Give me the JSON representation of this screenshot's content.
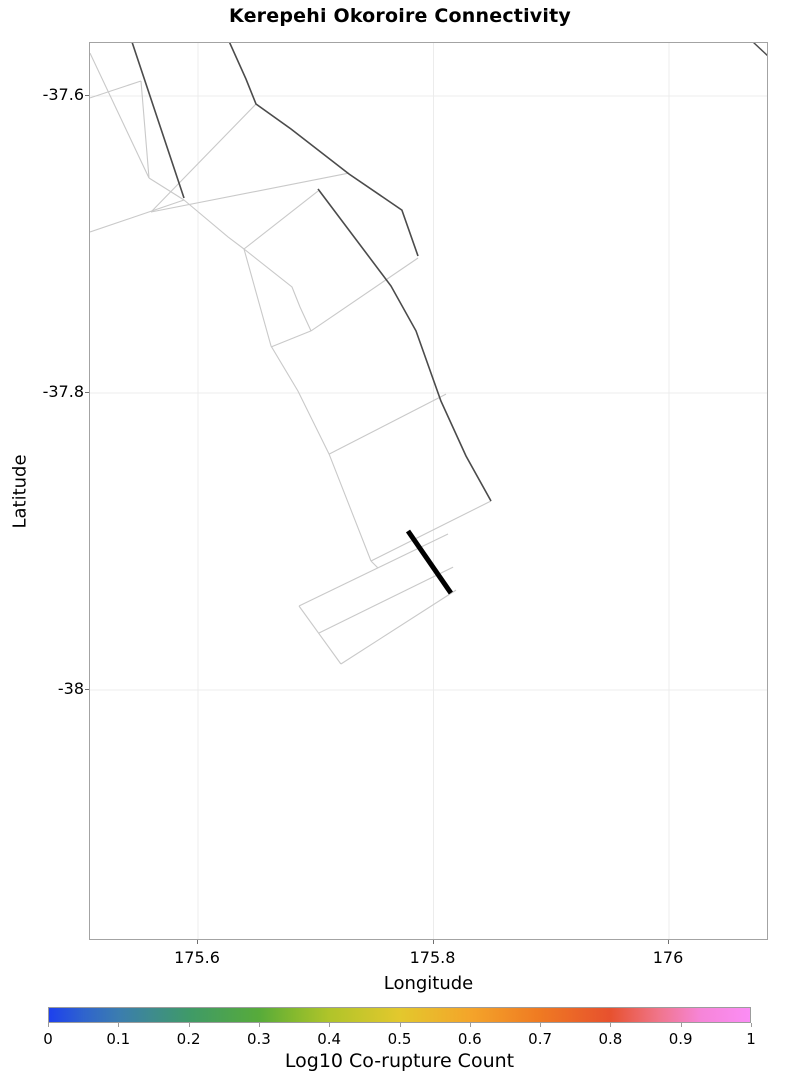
{
  "title": "Kerepehi Okoroire Connectivity",
  "axes": {
    "xlabel": "Longitude",
    "ylabel": "Latitude",
    "xticks": [
      175.6,
      175.8,
      176
    ],
    "xtick_labels": [
      "175.6",
      "175.8",
      "176"
    ],
    "yticks": [
      -37.6,
      -37.8,
      -38
    ],
    "ytick_labels": [
      "-37.6",
      "-37.8",
      "-38"
    ],
    "xlim": [
      175.5083,
      176.0849
    ],
    "ylim": [
      -38.169,
      -37.5643
    ],
    "grid": true,
    "grid_color": "#ececec",
    "border_color": "#a3a3a3"
  },
  "colorbar": {
    "label": "Log10 Co-rupture Count",
    "ticks": [
      "0",
      "0.1",
      "0.2",
      "0.3",
      "0.4",
      "0.5",
      "0.6",
      "0.7",
      "0.8",
      "0.9",
      "1"
    ],
    "tick_values": [
      0,
      0.1,
      0.2,
      0.3,
      0.4,
      0.5,
      0.6,
      0.7,
      0.8,
      0.9,
      1
    ],
    "range": [
      0,
      1
    ],
    "stops": [
      {
        "pos": 0.0,
        "color": "#1d40ee"
      },
      {
        "pos": 0.05,
        "color": "#2f64cd"
      },
      {
        "pos": 0.1,
        "color": "#3b7daf"
      },
      {
        "pos": 0.15,
        "color": "#3e8c8b"
      },
      {
        "pos": 0.2,
        "color": "#3f9a68"
      },
      {
        "pos": 0.3,
        "color": "#57ab3a"
      },
      {
        "pos": 0.35,
        "color": "#85b92e"
      },
      {
        "pos": 0.4,
        "color": "#b0c42a"
      },
      {
        "pos": 0.5,
        "color": "#e3c82d"
      },
      {
        "pos": 0.6,
        "color": "#f4a52a"
      },
      {
        "pos": 0.7,
        "color": "#ef7a22"
      },
      {
        "pos": 0.8,
        "color": "#e7512e"
      },
      {
        "pos": 0.87,
        "color": "#f0758b"
      },
      {
        "pos": 0.93,
        "color": "#f685d8"
      },
      {
        "pos": 1.0,
        "color": "#fb8df5"
      }
    ]
  },
  "line_colors": {
    "light": "#c9c9c9",
    "dark": "#4b4b4b",
    "highlight": "#000000"
  },
  "chart_data": {
    "type": "line",
    "title": "Kerepehi Okoroire Connectivity",
    "xlabel": "Longitude",
    "ylabel": "Latitude",
    "xlim": [
      175.5083,
      176.0849
    ],
    "ylim": [
      -38.169,
      -37.5643
    ],
    "grid": true,
    "legend": "none",
    "description": "Map of fault surface traces; one highlighted thick black segment, dark connected traces, remaining network in light gray.",
    "faults": [
      {
        "id": "dark-trace-1",
        "shade": "dark",
        "width": 1.6,
        "points": [
          [
            175.5431,
            -37.5616
          ],
          [
            175.5881,
            -37.6687
          ]
        ]
      },
      {
        "id": "dark-trace-2",
        "shade": "dark",
        "width": 1.6,
        "points": [
          [
            175.6255,
            -37.5616
          ],
          [
            175.6408,
            -37.5886
          ],
          [
            175.6493,
            -37.6054
          ],
          [
            175.679,
            -37.6222
          ],
          [
            175.7282,
            -37.6525
          ],
          [
            175.7732,
            -37.6768
          ],
          [
            175.7868,
            -37.7077
          ]
        ]
      },
      {
        "id": "dark-trace-3",
        "shade": "dark",
        "width": 1.6,
        "points": [
          [
            175.7019,
            -37.6626
          ],
          [
            175.7639,
            -37.7279
          ],
          [
            175.7851,
            -37.7582
          ],
          [
            175.8063,
            -37.8054
          ],
          [
            175.8276,
            -37.8424
          ],
          [
            175.8488,
            -37.8727
          ]
        ]
      },
      {
        "id": "dark-trace-corner",
        "shade": "dark",
        "width": 1.4,
        "points": [
          [
            176.0713,
            -37.5636
          ],
          [
            176.0849,
            -37.5737
          ]
        ]
      },
      {
        "id": "highlight-segment",
        "shade": "highlight",
        "width": 5,
        "points": [
          [
            175.7783,
            -37.8929
          ],
          [
            175.8148,
            -37.9347
          ]
        ]
      },
      {
        "id": "trace-l1",
        "shade": "light",
        "width": 1.1,
        "points": [
          [
            175.5083,
            -37.5711
          ],
          [
            175.5584,
            -37.6552
          ]
        ]
      },
      {
        "id": "trace-l2",
        "shade": "light",
        "width": 1.1,
        "points": [
          [
            175.5083,
            -37.6013
          ],
          [
            175.5516,
            -37.5899
          ]
        ]
      },
      {
        "id": "trace-l3",
        "shade": "light",
        "width": 1.1,
        "points": [
          [
            175.5516,
            -37.5899
          ],
          [
            175.5584,
            -37.6552
          ]
        ]
      },
      {
        "id": "trace-l4",
        "shade": "light",
        "width": 1.1,
        "points": [
          [
            175.6493,
            -37.6054
          ],
          [
            175.5601,
            -37.6781
          ]
        ]
      },
      {
        "id": "trace-l5a",
        "shade": "light",
        "width": 1.1,
        "points": [
          [
            175.5584,
            -37.6552
          ],
          [
            175.5881,
            -37.67
          ]
        ]
      },
      {
        "id": "trace-l5b",
        "shade": "light",
        "width": 1.1,
        "points": [
          [
            175.5881,
            -37.67
          ],
          [
            175.5083,
            -37.6916
          ]
        ]
      },
      {
        "id": "trace-l12",
        "shade": "light",
        "width": 1.1,
        "points": [
          [
            175.5601,
            -37.6781
          ],
          [
            175.7282,
            -37.6519
          ]
        ]
      },
      {
        "id": "trace-l6-snake",
        "shade": "light",
        "width": 1.1,
        "points": [
          [
            175.5881,
            -37.67
          ],
          [
            175.6255,
            -37.6949
          ],
          [
            175.6391,
            -37.703
          ],
          [
            175.662,
            -37.7683
          ],
          [
            175.6849,
            -37.7987
          ],
          [
            175.7113,
            -37.8411
          ],
          [
            175.7469,
            -37.9131
          ]
        ]
      },
      {
        "id": "trace-l7",
        "shade": "light",
        "width": 1.1,
        "points": [
          [
            175.7113,
            -37.8411
          ],
          [
            175.8106,
            -37.8007
          ]
        ]
      },
      {
        "id": "trace-l8",
        "shade": "light",
        "width": 1.1,
        "points": [
          [
            175.6391,
            -37.703
          ],
          [
            175.7019,
            -37.664
          ]
        ]
      },
      {
        "id": "trace-l9",
        "shade": "light",
        "width": 1.1,
        "points": [
          [
            175.6391,
            -37.703
          ],
          [
            175.6798,
            -37.7286
          ],
          [
            175.6866,
            -37.7421
          ],
          [
            175.696,
            -37.7582
          ]
        ]
      },
      {
        "id": "trace-l10",
        "shade": "light",
        "width": 1.1,
        "points": [
          [
            175.696,
            -37.7582
          ],
          [
            175.7868,
            -37.7091
          ]
        ]
      },
      {
        "id": "trace-l11",
        "shade": "light",
        "width": 1.1,
        "points": [
          [
            175.696,
            -37.7582
          ],
          [
            175.662,
            -37.769
          ]
        ]
      },
      {
        "id": "trace-l14",
        "shade": "light",
        "width": 1.1,
        "points": [
          [
            175.7469,
            -37.9131
          ],
          [
            175.8488,
            -37.8727
          ]
        ]
      },
      {
        "id": "trace-l15",
        "shade": "light",
        "width": 1.1,
        "points": [
          [
            175.7469,
            -37.9131
          ],
          [
            175.7529,
            -37.9178
          ]
        ]
      },
      {
        "id": "trace-rect-left",
        "shade": "light",
        "width": 1.1,
        "points": [
          [
            175.6858,
            -37.9434
          ],
          [
            175.7214,
            -37.9825
          ]
        ]
      },
      {
        "id": "trace-rect-top",
        "shade": "light",
        "width": 1.1,
        "points": [
          [
            175.6858,
            -37.9434
          ],
          [
            175.8123,
            -37.8949
          ]
        ]
      },
      {
        "id": "trace-rect-mid",
        "shade": "light",
        "width": 1.1,
        "points": [
          [
            175.7028,
            -37.9616
          ],
          [
            175.8166,
            -37.9172
          ]
        ]
      },
      {
        "id": "trace-rect-bottom",
        "shade": "light",
        "width": 1.1,
        "points": [
          [
            175.7214,
            -37.9825
          ],
          [
            175.8191,
            -37.9327
          ]
        ]
      }
    ]
  }
}
